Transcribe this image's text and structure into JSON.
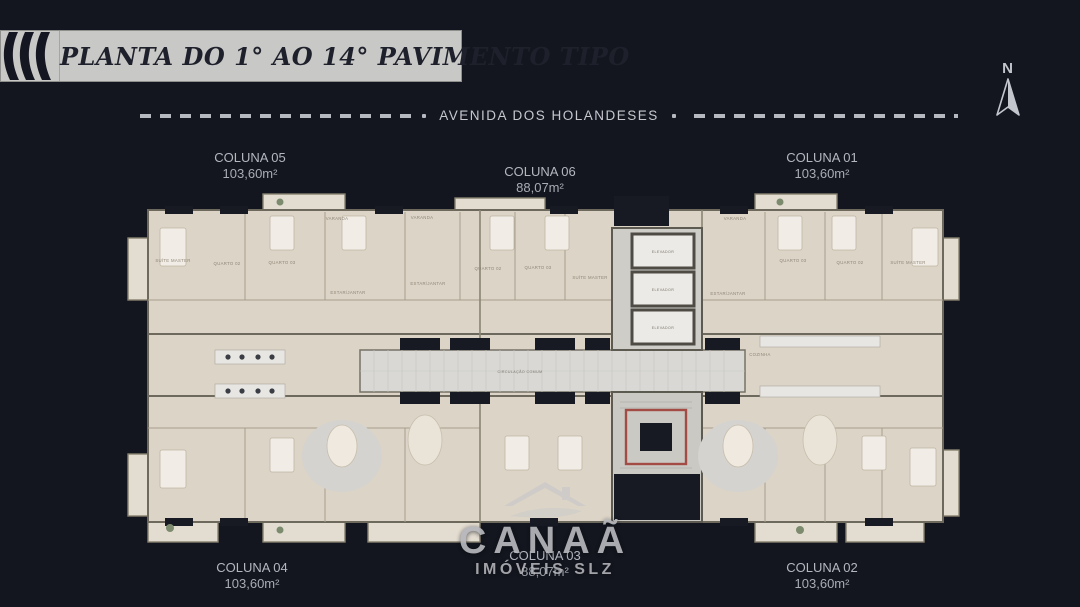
{
  "header": {
    "title": "PLANTA DO 1° AO 14° PAVIMENTO TIPO",
    "street": "AVENIDA DOS HOLANDESES",
    "compass_n": "N"
  },
  "units": [
    {
      "id": "coluna-05",
      "name": "COLUNA 05",
      "area": "103,60m²"
    },
    {
      "id": "coluna-06",
      "name": "COLUNA 06",
      "area": "88,07m²"
    },
    {
      "id": "coluna-01",
      "name": "COLUNA 01",
      "area": "103,60m²"
    },
    {
      "id": "coluna-04",
      "name": "COLUNA 04",
      "area": "103,60m²"
    },
    {
      "id": "coluna-03",
      "name": "COLUNA 03",
      "area": "88,07m²"
    },
    {
      "id": "coluna-02",
      "name": "COLUNA 02",
      "area": "103,60m²"
    }
  ],
  "plan": {
    "labels": {
      "suite_master": "SUÍTE MASTER",
      "quarto_02": "QUARTO 02",
      "quarto_03": "QUARTO 03",
      "estar_jantar": "ESTAR/JANTAR",
      "varanda": "VARANDA",
      "cozinha": "COZINHA",
      "circulacao": "CIRCULAÇÃO COMUM",
      "elevador": "ELEVADOR"
    }
  },
  "watermark": {
    "brand": "CANAÃ",
    "tagline": "IMÓVEIS SLZ"
  },
  "colors": {
    "background": "#14161f",
    "banner": "#c8c8c6",
    "banner_text": "#1e212b",
    "label_text": "#b4b7bf",
    "floor": "#dcd4c6",
    "balcony": "#e3dcd1",
    "corridor": "#d9d8d4",
    "wall": "#6e695d",
    "opening_dark": "#171a23",
    "stair_rail_red": "#a24c45"
  }
}
